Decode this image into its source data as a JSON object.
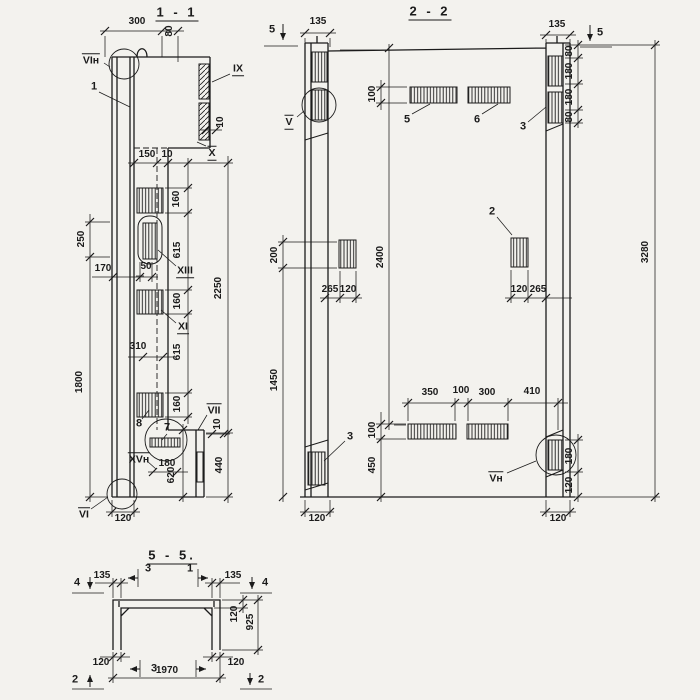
{
  "colors": {
    "paper": "#f3f2ee",
    "ink": "#1b1b1b"
  },
  "labels": [
    {
      "text": "1 - 1",
      "x": 177,
      "y": 13,
      "kind": "title",
      "rot": 0,
      "deco": ""
    },
    {
      "text": "300",
      "x": 137,
      "y": 22,
      "kind": "dim",
      "rot": 0,
      "deco": ""
    },
    {
      "text": "80",
      "x": 170,
      "y": 31,
      "kind": "dim",
      "rot": 1,
      "deco": ""
    },
    {
      "text": "VIн",
      "x": 91,
      "y": 60,
      "kind": "node",
      "rot": 0,
      "deco": "o"
    },
    {
      "text": "1",
      "x": 94,
      "y": 87,
      "kind": "num",
      "rot": 0,
      "deco": ""
    },
    {
      "text": "IX",
      "x": 238,
      "y": 69,
      "kind": "node",
      "rot": 0,
      "deco": "u"
    },
    {
      "text": "10",
      "x": 221,
      "y": 122,
      "kind": "dim",
      "rot": 1,
      "deco": ""
    },
    {
      "text": "X",
      "x": 212,
      "y": 153,
      "kind": "node",
      "rot": 0,
      "deco": "ou"
    },
    {
      "text": "150",
      "x": 147,
      "y": 155,
      "kind": "dim",
      "rot": 0,
      "deco": ""
    },
    {
      "text": "10",
      "x": 167,
      "y": 155,
      "kind": "dim",
      "rot": 0,
      "deco": ""
    },
    {
      "text": "160",
      "x": 177,
      "y": 199,
      "kind": "dim",
      "rot": 1,
      "deco": ""
    },
    {
      "text": "615",
      "x": 178,
      "y": 250,
      "kind": "dim",
      "rot": 1,
      "deco": ""
    },
    {
      "text": "2250",
      "x": 219,
      "y": 288,
      "kind": "dim",
      "rot": 1,
      "deco": ""
    },
    {
      "text": "170",
      "x": 103,
      "y": 269,
      "kind": "dim",
      "rot": 0,
      "deco": ""
    },
    {
      "text": "50",
      "x": 146,
      "y": 267,
      "kind": "dim",
      "rot": 0,
      "deco": ""
    },
    {
      "text": "XIII",
      "x": 185,
      "y": 271,
      "kind": "node",
      "rot": 0,
      "deco": "u"
    },
    {
      "text": "160",
      "x": 178,
      "y": 301,
      "kind": "dim",
      "rot": 1,
      "deco": ""
    },
    {
      "text": "XI",
      "x": 183,
      "y": 327,
      "kind": "node",
      "rot": 0,
      "deco": "u"
    },
    {
      "text": "310",
      "x": 138,
      "y": 347,
      "kind": "dim",
      "rot": 0,
      "deco": ""
    },
    {
      "text": "615",
      "x": 178,
      "y": 352,
      "kind": "dim",
      "rot": 1,
      "deco": ""
    },
    {
      "text": "160",
      "x": 178,
      "y": 404,
      "kind": "dim",
      "rot": 1,
      "deco": ""
    },
    {
      "text": "8",
      "x": 139,
      "y": 424,
      "kind": "num",
      "rot": 0,
      "deco": ""
    },
    {
      "text": "7",
      "x": 167,
      "y": 428,
      "kind": "num",
      "rot": 0,
      "deco": ""
    },
    {
      "text": "VII",
      "x": 214,
      "y": 410,
      "kind": "node",
      "rot": 0,
      "deco": "o"
    },
    {
      "text": "10",
      "x": 218,
      "y": 424,
      "kind": "dim",
      "rot": 1,
      "deco": ""
    },
    {
      "text": "440",
      "x": 220,
      "y": 465,
      "kind": "dim",
      "rot": 1,
      "deco": ""
    },
    {
      "text": "XVн",
      "x": 139,
      "y": 459,
      "kind": "node",
      "rot": 0,
      "deco": "o"
    },
    {
      "text": "180",
      "x": 167,
      "y": 464,
      "kind": "dim",
      "rot": 0,
      "deco": ""
    },
    {
      "text": "620",
      "x": 172,
      "y": 475,
      "kind": "dim",
      "rot": 1,
      "deco": ""
    },
    {
      "text": "VI",
      "x": 84,
      "y": 514,
      "kind": "node",
      "rot": 0,
      "deco": "o"
    },
    {
      "text": "120",
      "x": 123,
      "y": 519,
      "kind": "dim",
      "rot": 0,
      "deco": ""
    },
    {
      "text": "250",
      "x": 82,
      "y": 239,
      "kind": "dim",
      "rot": 1,
      "deco": ""
    },
    {
      "text": "1800",
      "x": 80,
      "y": 382,
      "kind": "dim",
      "rot": 1,
      "deco": ""
    },
    {
      "text": "2 - 2",
      "x": 430,
      "y": 12,
      "kind": "title",
      "rot": 0,
      "deco": ""
    },
    {
      "text": "5",
      "x": 272,
      "y": 30,
      "kind": "mark",
      "rot": 0,
      "deco": ""
    },
    {
      "text": "135",
      "x": 318,
      "y": 22,
      "kind": "dim",
      "rot": 0,
      "deco": ""
    },
    {
      "text": "135",
      "x": 557,
      "y": 25,
      "kind": "dim",
      "rot": 0,
      "deco": ""
    },
    {
      "text": "5",
      "x": 600,
      "y": 33,
      "kind": "mark",
      "rot": 0,
      "deco": ""
    },
    {
      "text": "80",
      "x": 570,
      "y": 51,
      "kind": "dim",
      "rot": 1,
      "deco": ""
    },
    {
      "text": "180",
      "x": 570,
      "y": 71,
      "kind": "dim",
      "rot": 1,
      "deco": ""
    },
    {
      "text": "180",
      "x": 570,
      "y": 97,
      "kind": "dim",
      "rot": 1,
      "deco": ""
    },
    {
      "text": "80",
      "x": 570,
      "y": 117,
      "kind": "dim",
      "rot": 1,
      "deco": ""
    },
    {
      "text": "V",
      "x": 289,
      "y": 122,
      "kind": "node",
      "rot": 0,
      "deco": "ou"
    },
    {
      "text": "100",
      "x": 373,
      "y": 94,
      "kind": "dim",
      "rot": 1,
      "deco": ""
    },
    {
      "text": "5",
      "x": 407,
      "y": 120,
      "kind": "num",
      "rot": 0,
      "deco": ""
    },
    {
      "text": "6",
      "x": 477,
      "y": 120,
      "kind": "num",
      "rot": 0,
      "deco": ""
    },
    {
      "text": "3",
      "x": 523,
      "y": 127,
      "kind": "num",
      "rot": 0,
      "deco": ""
    },
    {
      "text": "2",
      "x": 492,
      "y": 212,
      "kind": "num",
      "rot": 0,
      "deco": ""
    },
    {
      "text": "200",
      "x": 275,
      "y": 255,
      "kind": "dim",
      "rot": 1,
      "deco": ""
    },
    {
      "text": "2400",
      "x": 381,
      "y": 257,
      "kind": "dim",
      "rot": 1,
      "deco": ""
    },
    {
      "text": "3280",
      "x": 646,
      "y": 252,
      "kind": "dim",
      "rot": 1,
      "deco": ""
    },
    {
      "text": "265",
      "x": 330,
      "y": 290,
      "kind": "dim",
      "rot": 0,
      "deco": ""
    },
    {
      "text": "120",
      "x": 348,
      "y": 290,
      "kind": "dim",
      "rot": 0,
      "deco": ""
    },
    {
      "text": "120",
      "x": 519,
      "y": 290,
      "kind": "dim",
      "rot": 0,
      "deco": ""
    },
    {
      "text": "265",
      "x": 538,
      "y": 290,
      "kind": "dim",
      "rot": 0,
      "deco": ""
    },
    {
      "text": "1450",
      "x": 275,
      "y": 380,
      "kind": "dim",
      "rot": 1,
      "deco": ""
    },
    {
      "text": "350",
      "x": 430,
      "y": 393,
      "kind": "dim",
      "rot": 0,
      "deco": ""
    },
    {
      "text": "100",
      "x": 461,
      "y": 391,
      "kind": "dim",
      "rot": 0,
      "deco": ""
    },
    {
      "text": "300",
      "x": 487,
      "y": 393,
      "kind": "dim",
      "rot": 0,
      "deco": ""
    },
    {
      "text": "410",
      "x": 532,
      "y": 392,
      "kind": "dim",
      "rot": 0,
      "deco": ""
    },
    {
      "text": "100",
      "x": 373,
      "y": 430,
      "kind": "dim",
      "rot": 1,
      "deco": ""
    },
    {
      "text": "450",
      "x": 373,
      "y": 465,
      "kind": "dim",
      "rot": 1,
      "deco": ""
    },
    {
      "text": "3",
      "x": 350,
      "y": 437,
      "kind": "num",
      "rot": 0,
      "deco": ""
    },
    {
      "text": "Vн",
      "x": 496,
      "y": 478,
      "kind": "node",
      "rot": 0,
      "deco": "o"
    },
    {
      "text": "180",
      "x": 570,
      "y": 456,
      "kind": "dim",
      "rot": 1,
      "deco": ""
    },
    {
      "text": "120",
      "x": 570,
      "y": 485,
      "kind": "dim",
      "rot": 1,
      "deco": ""
    },
    {
      "text": "120",
      "x": 317,
      "y": 519,
      "kind": "dim",
      "rot": 0,
      "deco": ""
    },
    {
      "text": "120",
      "x": 558,
      "y": 519,
      "kind": "dim",
      "rot": 0,
      "deco": ""
    },
    {
      "text": "5 - 5.",
      "x": 172,
      "y": 556,
      "kind": "title",
      "rot": 0,
      "deco": ""
    },
    {
      "text": "4",
      "x": 77,
      "y": 583,
      "kind": "mark",
      "rot": 0,
      "deco": ""
    },
    {
      "text": "135",
      "x": 102,
      "y": 576,
      "kind": "dim",
      "rot": 0,
      "deco": ""
    },
    {
      "text": "3",
      "x": 148,
      "y": 569,
      "kind": "num",
      "rot": 0,
      "deco": ""
    },
    {
      "text": "1",
      "x": 190,
      "y": 569,
      "kind": "num",
      "rot": 0,
      "deco": ""
    },
    {
      "text": "135",
      "x": 233,
      "y": 576,
      "kind": "dim",
      "rot": 0,
      "deco": ""
    },
    {
      "text": "4",
      "x": 265,
      "y": 583,
      "kind": "mark",
      "rot": 0,
      "deco": ""
    },
    {
      "text": "120",
      "x": 235,
      "y": 614,
      "kind": "dim",
      "rot": 1,
      "deco": ""
    },
    {
      "text": "925",
      "x": 251,
      "y": 622,
      "kind": "dim",
      "rot": 1,
      "deco": ""
    },
    {
      "text": "120",
      "x": 101,
      "y": 663,
      "kind": "dim",
      "rot": 0,
      "deco": ""
    },
    {
      "text": "3",
      "x": 154,
      "y": 669,
      "kind": "num",
      "rot": 0,
      "deco": ""
    },
    {
      "text": "120",
      "x": 236,
      "y": 663,
      "kind": "dim",
      "rot": 0,
      "deco": ""
    },
    {
      "text": "1970",
      "x": 167,
      "y": 671,
      "kind": "dim",
      "rot": 0,
      "deco": ""
    },
    {
      "text": "2",
      "x": 75,
      "y": 680,
      "kind": "mark",
      "rot": 0,
      "deco": ""
    },
    {
      "text": "2",
      "x": 261,
      "y": 680,
      "kind": "mark",
      "rot": 0,
      "deco": ""
    }
  ]
}
